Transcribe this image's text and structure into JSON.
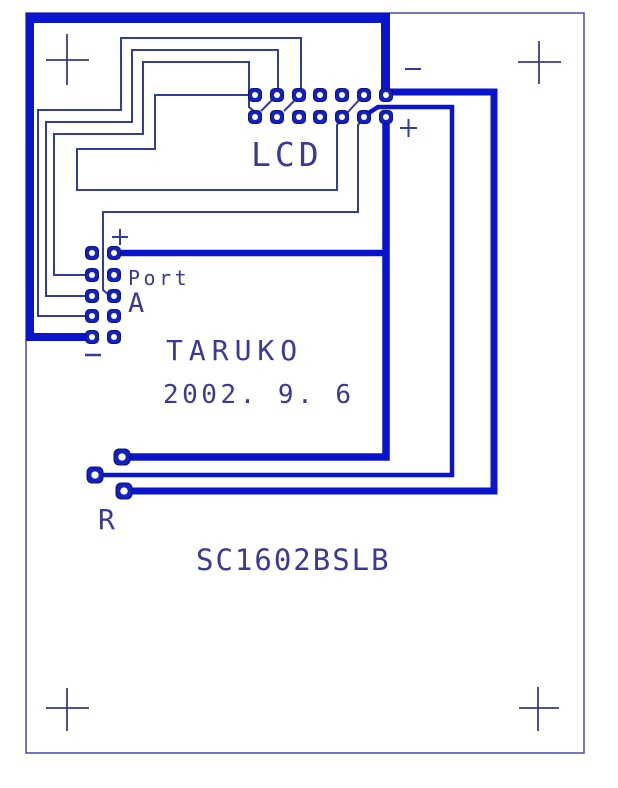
{
  "board_title": "SC1602BSLB",
  "colors": {
    "background": "#fffffd",
    "thick_trace": "#0a14cc",
    "thin_trace": "#323b9e",
    "outline": "#4747b2",
    "text": "#39399b",
    "pad": "#1520c0",
    "pad_hole": "#ffffff",
    "crosshair": "#3a3a96"
  },
  "labels": {
    "lcd": {
      "text": "LCD",
      "left": 251,
      "top": 138,
      "fontSize": 33,
      "letterSpacing": 4
    },
    "port": {
      "text": "Port",
      "left": 128,
      "top": 268,
      "fontSize": 20,
      "letterSpacing": 3.5
    },
    "a": {
      "text": "A",
      "left": 128,
      "top": 290,
      "fontSize": 27,
      "letterSpacing": 0
    },
    "taruko": {
      "text": "TARUKO",
      "left": 166,
      "top": 337,
      "fontSize": 28,
      "letterSpacing": 6
    },
    "date": {
      "text": "2002. 9. 6",
      "left": 163,
      "top": 382,
      "fontSize": 26,
      "letterSpacing": 3.5
    },
    "r": {
      "text": "R",
      "left": 98,
      "top": 506,
      "fontSize": 28,
      "letterSpacing": 0
    },
    "part": {
      "text": "SC1602BSLB",
      "left": 196,
      "top": 546,
      "fontSize": 29,
      "letterSpacing": 2
    }
  },
  "marks": [
    {
      "name": "minus-top",
      "label": "-",
      "lines": [
        [
          405,
          69,
          421,
          69
        ]
      ],
      "width": 2
    },
    {
      "name": "plus-right",
      "label": "+",
      "lines": [
        [
          400,
          128,
          417,
          128
        ],
        [
          408.5,
          119,
          408.5,
          137
        ]
      ],
      "width": 2
    },
    {
      "name": "plus-port",
      "label": "+",
      "lines": [
        [
          112,
          237,
          128,
          237
        ],
        [
          120,
          229,
          120,
          245
        ]
      ],
      "width": 2
    },
    {
      "name": "minus-port",
      "label": "-",
      "lines": [
        [
          85,
          355,
          101,
          355
        ]
      ],
      "width": 2.5
    }
  ],
  "crosshairs": [
    {
      "name": "fiducial-top-left",
      "v": [
        67,
        34,
        67,
        85
      ],
      "h": [
        46,
        60,
        89,
        60
      ]
    },
    {
      "name": "fiducial-top-right",
      "v": [
        539,
        41,
        539,
        84
      ],
      "h": [
        518,
        62,
        561,
        62
      ]
    },
    {
      "name": "fiducial-bottom-left",
      "v": [
        67,
        688,
        67,
        731
      ],
      "h": [
        46,
        708,
        89,
        708
      ]
    },
    {
      "name": "fiducial-bottom-right",
      "v": [
        538,
        687,
        538,
        731
      ],
      "h": [
        519,
        708,
        559,
        708
      ]
    }
  ],
  "board": {
    "outline": {
      "x": 26,
      "y": 13,
      "w": 558,
      "h": 740,
      "strokeWidth": 1.5
    },
    "bars": [
      {
        "name": "thick-bar-top",
        "x": 26,
        "y": 13,
        "w": 364,
        "h": 10
      },
      {
        "name": "thick-bar-top-drop",
        "x": 381,
        "y": 13,
        "w": 9,
        "h": 82
      },
      {
        "name": "thick-bar-left",
        "x": 26,
        "y": 13,
        "w": 8,
        "h": 328
      },
      {
        "name": "thick-feed-port-minus",
        "x": 26,
        "y": 333,
        "w": 66,
        "h": 8
      }
    ]
  },
  "traces": {
    "thick": [
      {
        "name": "thick-trace-t3",
        "width": 7,
        "points": [
          [
            386,
            92
          ],
          [
            494,
            92
          ],
          [
            494,
            491
          ],
          [
            131,
            491
          ]
        ]
      },
      {
        "name": "thick-trace-t1",
        "width": 7.5,
        "points": [
          [
            386,
            117
          ],
          [
            386,
            457
          ],
          [
            129,
            457
          ]
        ]
      },
      {
        "name": "thick-trace-t2",
        "width": 4.5,
        "points": [
          [
            364,
            116
          ],
          [
            378,
            107
          ],
          [
            452,
            107
          ],
          [
            452,
            475
          ],
          [
            103,
            475
          ]
        ]
      },
      {
        "name": "thick-trace-port-plus",
        "width": 6.5,
        "points": [
          [
            114,
            253
          ],
          [
            383,
            253
          ]
        ]
      }
    ],
    "thin": [
      {
        "name": "thin-trace-c1",
        "width": 2,
        "points": [
          [
            301,
            90
          ],
          [
            301,
            38
          ],
          [
            121,
            38
          ],
          [
            121,
            110
          ],
          [
            38,
            110
          ],
          [
            38,
            316
          ],
          [
            88,
            316
          ]
        ]
      },
      {
        "name": "thin-trace-c2",
        "width": 2,
        "points": [
          [
            278,
            90
          ],
          [
            278,
            50
          ],
          [
            132,
            50
          ],
          [
            132,
            122
          ],
          [
            46,
            122
          ],
          [
            46,
            296
          ],
          [
            88,
            296
          ]
        ]
      },
      {
        "name": "thin-trace-c3",
        "width": 2,
        "points": [
          [
            255,
            112
          ],
          [
            249,
            107
          ],
          [
            249,
            62
          ],
          [
            143,
            62
          ],
          [
            143,
            134
          ],
          [
            54,
            134
          ],
          [
            54,
            275
          ],
          [
            88,
            275
          ]
        ]
      },
      {
        "name": "thin-trace-c4",
        "width": 2,
        "points": [
          [
            251,
            95
          ],
          [
            155,
            95
          ],
          [
            155,
            149
          ],
          [
            77,
            149
          ],
          [
            77,
            190
          ],
          [
            337,
            190
          ],
          [
            337,
            125
          ],
          [
            342,
            119
          ]
        ]
      },
      {
        "name": "thin-trace-c5",
        "width": 2,
        "points": [
          [
            363,
            119
          ],
          [
            358,
            125
          ],
          [
            358,
            212
          ],
          [
            103,
            212
          ],
          [
            103,
            290
          ],
          [
            109,
            295
          ]
        ]
      },
      {
        "name": "thin-stub-d1",
        "width": 2,
        "points": [
          [
            272,
            100
          ],
          [
            261,
            111
          ]
        ]
      },
      {
        "name": "thin-stub-d2",
        "width": 2,
        "points": [
          [
            295,
            100
          ],
          [
            284,
            111
          ]
        ]
      },
      {
        "name": "thin-stub-d3",
        "width": 2,
        "points": [
          [
            359,
            100
          ],
          [
            348,
            112
          ]
        ]
      }
    ]
  },
  "pads": {
    "lcd_connector": {
      "cols": [
        255,
        277,
        299,
        320,
        342,
        364,
        386
      ],
      "rows": [
        95,
        117
      ],
      "size": 13
    },
    "port_connector": {
      "cols": [
        92,
        114
      ],
      "rows": [
        253,
        275,
        296,
        316,
        337
      ],
      "size": 13
    },
    "r_pads": {
      "centers": [
        [
          122,
          457
        ],
        [
          95,
          475
        ],
        [
          124,
          491
        ]
      ],
      "size": 16
    }
  }
}
